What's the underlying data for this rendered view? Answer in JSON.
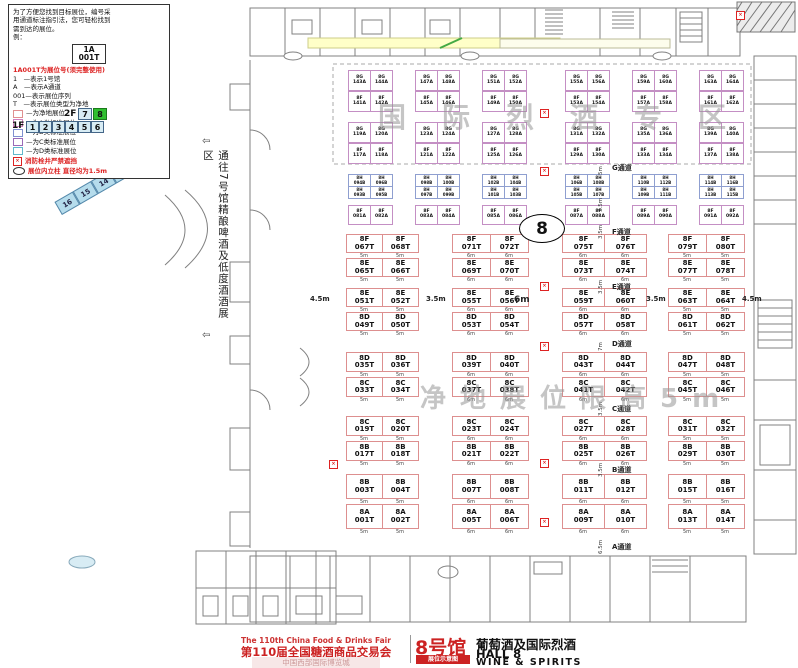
{
  "legend": {
    "intro_lines": [
      "为了方便您找到目标展位，编号采",
      "用通道标注指引法，您可轻松找到",
      "需到达的展位。",
      "例："
    ],
    "example": {
      "line1": "1A",
      "line2": "001T"
    },
    "code_note": "1A001T为展位号(须完整使用)",
    "items": [
      "1　—表示1号馆",
      "A　—表示A通道",
      "001—表示展位序列",
      "T　—表示展位类型为净地"
    ],
    "swatches": [
      {
        "label": "—为净地展位",
        "color": "#e09090"
      },
      {
        "label": "—为A类标准展位",
        "color": "#d080c0"
      },
      {
        "label": "—为B类标准展位",
        "color": "#8090d0"
      },
      {
        "label": "—为C类标准展位",
        "color": "#9a6ab8"
      },
      {
        "label": "—为D类标准展位",
        "color": "#60b8cc"
      }
    ],
    "fire_note": "消防栓井严禁遮挡",
    "column_note": "展位内立柱 直径均为1.5m",
    "fire_mark": "×"
  },
  "floor_selector": {
    "f2_label": "2F",
    "f2_halls": [
      "7",
      "8"
    ],
    "active_hall": "8",
    "f1_label": "1F",
    "f1_halls": [
      "1",
      "2",
      "3",
      "4",
      "5",
      "6"
    ],
    "wing_blue": [
      "10",
      "11",
      "14",
      "15",
      "16"
    ],
    "wing_diamond": "9",
    "wing_green": [
      "12",
      "13"
    ]
  },
  "side_label": {
    "text": "通往7号馆精酿啤酒及低度酒酒展区",
    "arrow": "⇦"
  },
  "watermarks": {
    "top": "国际烈酒专区",
    "middle": "净地展位限高5m"
  },
  "hall_circle": "8",
  "map": {
    "spirits_zone": {
      "rows": [
        {
          "islands": [
            [
              "8G 143A",
              "8G 144A",
              "8F 141A",
              "8F 142A"
            ],
            [
              "8G 147A",
              "8G 148A",
              "8F 145A",
              "8F 146A"
            ],
            [
              "8G 151A",
              "8G 152A",
              "8F 149A",
              "8F 150A"
            ],
            [
              "8G 155A",
              "8G 156A",
              "8F 153A",
              "8F 154A"
            ],
            [
              "8G 159A",
              "8G 160A",
              "8F 157A",
              "8F 158A"
            ],
            [
              "8G 163A",
              "8G 164A",
              "8F 161A",
              "8F 162A"
            ]
          ]
        },
        {
          "islands": [
            [
              "8G 119A",
              "8G 120A",
              "8F 117A",
              "8F 118A"
            ],
            [
              "8G 123A",
              "8G 124A",
              "8F 121A",
              "8F 122A"
            ],
            [
              "8G 127A",
              "8G 128A",
              "8F 125A",
              "8F 126A"
            ],
            [
              "8G 131A",
              "8G 132A",
              "8F 129A",
              "8F 130A"
            ],
            [
              "8G 135A",
              "8G 136A",
              "8F 133A",
              "8F 134A"
            ],
            [
              "8G 139A",
              "8G 140A",
              "8F 137A",
              "8F 138A"
            ]
          ]
        }
      ]
    },
    "h_row": {
      "islands": [
        [
          "8H 094B",
          "8H 096B",
          "8H 093B",
          "8H 095B"
        ],
        [
          "8H 098B",
          "8H 100B",
          "8H 097B",
          "8H 099B"
        ],
        [
          "8H 102B",
          "8H 104B",
          "8H 101B",
          "8H 103B"
        ],
        [
          "8H 106B",
          "8H 108B",
          "8H 105B",
          "8H 107B"
        ],
        [
          "8H 110B",
          "8H 112B",
          "8H 109B",
          "8H 111B"
        ],
        [
          "8H 114B",
          "8H 116B",
          "8H 113B",
          "8H 115B"
        ]
      ]
    },
    "f_singles": [
      [
        "8F 081A",
        "8F 082A"
      ],
      [
        "8F 083A",
        "8F 084A"
      ],
      [
        "8F 085A",
        "8F 086A"
      ],
      [
        "8F 087A",
        "8F 088A"
      ],
      [
        "8F 089A",
        "8F 090A"
      ],
      [
        "8F 091A",
        "8F 092A"
      ]
    ],
    "main_grid": {
      "col_dims": [
        "5m",
        "6m",
        "6m",
        "5m"
      ],
      "bands": [
        {
          "top": [
            "8F 067T",
            "8F 068T",
            "8F 071T",
            "8F 072T",
            "8F 075T",
            "8F 076T",
            "8F 079T",
            "8F 080T"
          ],
          "bottom": [
            "8E 065T",
            "8E 066T",
            "8E 069T",
            "8E 070T",
            "8E 073T",
            "8E 074T",
            "8E 077T",
            "8E 078T"
          ]
        },
        {
          "top": [
            "8E 051T",
            "8E 052T",
            "8E 055T",
            "8E 056T",
            "8E 059T",
            "8E 060T",
            "8E 063T",
            "8E 064T"
          ],
          "bottom": [
            "8D 049T",
            "8D 050T",
            "8D 053T",
            "8D 054T",
            "8D 057T",
            "8D 058T",
            "8D 061T",
            "8D 062T"
          ]
        },
        {
          "top": [
            "8D 035T",
            "8D 036T",
            "8D 039T",
            "8D 040T",
            "8D 043T",
            "8D 044T",
            "8D 047T",
            "8D 048T"
          ],
          "bottom": [
            "8C 033T",
            "8C 034T",
            "8C 037T",
            "8C 038T",
            "8C 041T",
            "8C 042T",
            "8C 045T",
            "8C 046T"
          ]
        },
        {
          "top": [
            "8C 019T",
            "8C 020T",
            "8C 023T",
            "8C 024T",
            "8C 027T",
            "8C 028T",
            "8C 031T",
            "8C 032T"
          ],
          "bottom": [
            "8B 017T",
            "8B 018T",
            "8B 021T",
            "8B 022T",
            "8B 025T",
            "8B 026T",
            "8B 029T",
            "8B 030T"
          ]
        },
        {
          "top": [
            "8B 003T",
            "8B 004T",
            "8B 007T",
            "8B 008T",
            "8B 011T",
            "8B 012T",
            "8B 015T",
            "8B 016T"
          ],
          "bottom": [
            "8A 001T",
            "8A 002T",
            "8A 005T",
            "8A 006T",
            "8A 009T",
            "8A 010T",
            "8A 013T",
            "8A 014T"
          ]
        }
      ]
    },
    "aisles": [
      {
        "name": "G通道",
        "dim": "5m"
      },
      {
        "name": "F通道",
        "dim": "3.5m"
      },
      {
        "name": "E通道",
        "dim": "3.5m"
      },
      {
        "name": "D通道",
        "dim": "7m"
      },
      {
        "name": "C通道",
        "dim": "3.5m"
      },
      {
        "name": "B通道",
        "dim": "3.5m"
      },
      {
        "name": "A通道",
        "dim": "6.5m"
      }
    ],
    "zone_dim": "3.5m",
    "cross_dims": [
      "4.5m",
      "3.5m",
      "6m",
      "3.5m",
      "4.5m"
    ]
  },
  "banner": {
    "en_title": "The 110th China Food & Drinks Fair",
    "cn_title": "第110届全国糖酒商品交易会",
    "sub_title": "中国西部国际博览城",
    "hall_cn": "8号馆",
    "badge": "展位示意图",
    "right_cn": "葡萄酒及国际烈酒",
    "hall_en": "HALL 8",
    "tagline": "WINE & SPIRITS"
  }
}
